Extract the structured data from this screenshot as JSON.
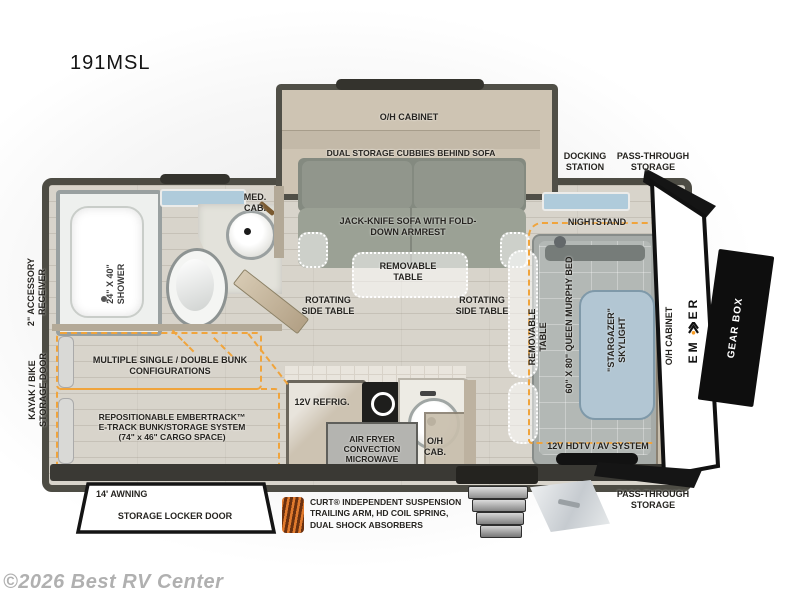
{
  "title": "191MSL",
  "watermark": "©2026 Best RV Center",
  "brand": {
    "name_left": "EM",
    "name_right": "ER",
    "gear_box": "GEAR BOX"
  },
  "exterior": {
    "docking_station": "DOCKING STATION",
    "pass_through_top": "PASS-THROUGH STORAGE",
    "pass_through_bottom": "PASS-THROUGH STORAGE",
    "accessory_receiver": "2\" ACCESSORY RECEIVER",
    "kayak_bike_door": "KAYAK / BIKE STORAGE DOOR",
    "awning": "14' AWNING",
    "storage_locker": "STORAGE LOCKER DOOR",
    "suspension_lines": [
      "CURT® INDEPENDENT SUSPENSION",
      "TRAILING ARM, HD COIL SPRING,",
      "DUAL SHOCK ABSORBERS"
    ]
  },
  "slideout": {
    "oh_cabinet": "O/H CABINET",
    "dual_storage": "DUAL STORAGE CUBBIES BEHIND SOFA",
    "sofa": "JACK-KNIFE SOFA WITH FOLD-DOWN ARMREST"
  },
  "living": {
    "removable_table": "REMOVABLE TABLE",
    "rotating_left": "ROTATING SIDE TABLE",
    "rotating_right": "ROTATING SIDE TABLE"
  },
  "bathroom": {
    "shower": "24\" X 40\" SHOWER",
    "med_cab": "MED. CAB."
  },
  "bunk": {
    "configurations": "MULTIPLE SINGLE / DOUBLE BUNK CONFIGURATIONS",
    "etrack_lines": [
      "REPOSITIONABLE EMBERTRACK™",
      "E-TRACK BUNK/STORAGE SYSTEM",
      "(74\" x 46\" CARGO SPACE)"
    ]
  },
  "kitchen": {
    "refrigerator": "12V REFRIG.",
    "microwave": "AIR FRYER CONVECTION MICROWAVE",
    "oh_cab": "O/H CAB."
  },
  "bedroom": {
    "nightstand": "NIGHTSTAND",
    "removable_table": "REMOVABLE TABLE",
    "murphy_bed": "60\" X 80\" QUEEN MURPHY BED",
    "skylight": "\"STARGAZER\" SKYLIGHT",
    "oh_cabinet": "O/H CABINET",
    "av_system": "12V HDTV / AV SYSTEM"
  },
  "colors": {
    "accent_orange": "#F0A43C",
    "wall_dark": "#4D4C44",
    "cabinet_tan": "#C8BEAC",
    "window_blue": "#AFCBDB",
    "brand_black": "#111111",
    "brand_dot_orange": "#F59A23"
  }
}
